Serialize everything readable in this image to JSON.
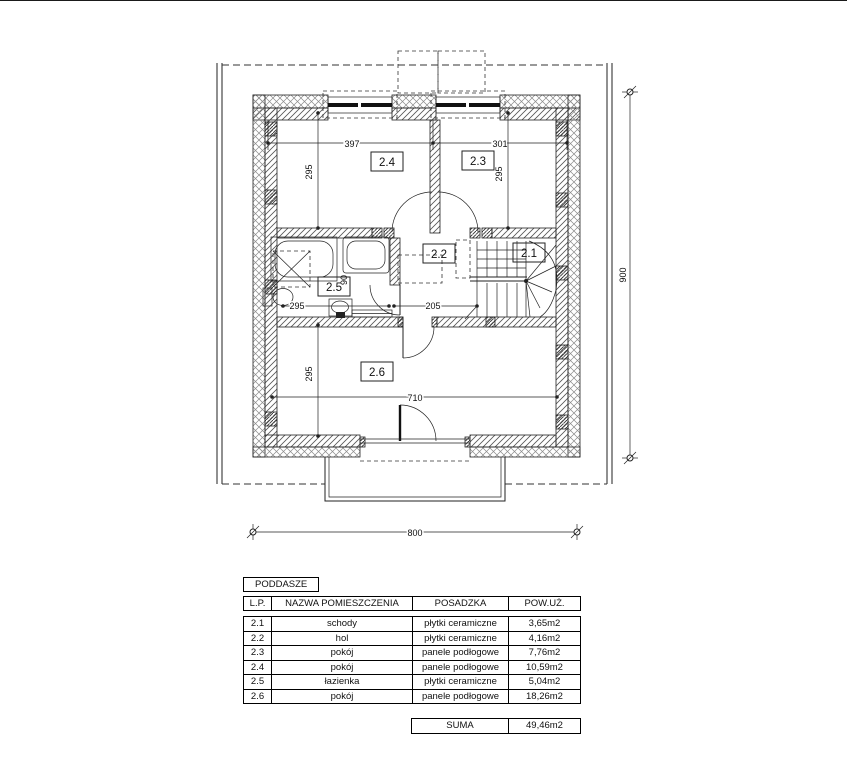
{
  "drawing": {
    "rooms": {
      "r21": "2.1",
      "r22": "2.2",
      "r23": "2.3",
      "r24": "2.4",
      "r25": "2.5",
      "r26": "2.6"
    },
    "dims": {
      "room24_width": "397",
      "room23_width": "301",
      "room24_depth": "295",
      "room23_depth": "295",
      "hall_width": "205",
      "bath_width": "295",
      "fixture_dim": "90",
      "room26_width": "710",
      "room26_depth": "295",
      "overall_width": "800",
      "overall_height": "900"
    },
    "line_color": "#222222",
    "background": "#ffffff"
  },
  "legend": {
    "title": "PODDASZE",
    "columns": [
      "L.P.",
      "NAZWA POMIESZCZENIA",
      "POSADZKA",
      "POW.UŻ."
    ],
    "rows": [
      {
        "lp": "2.1",
        "name": "schody",
        "floor": "płytki ceramiczne",
        "area": "3,65m2"
      },
      {
        "lp": "2.2",
        "name": "hol",
        "floor": "płytki ceramiczne",
        "area": "4,16m2"
      },
      {
        "lp": "2.3",
        "name": "pokój",
        "floor": "panele podłogowe",
        "area": "7,76m2"
      },
      {
        "lp": "2.4",
        "name": "pokój",
        "floor": "panele podłogowe",
        "area": "10,59m2"
      },
      {
        "lp": "2.5",
        "name": "łazienka",
        "floor": "płytki ceramiczne",
        "area": "5,04m2"
      },
      {
        "lp": "2.6",
        "name": "pokój",
        "floor": "panele podłogowe",
        "area": "18,26m2"
      }
    ],
    "sum_label": "SUMA",
    "sum_value": "49,46m2"
  }
}
